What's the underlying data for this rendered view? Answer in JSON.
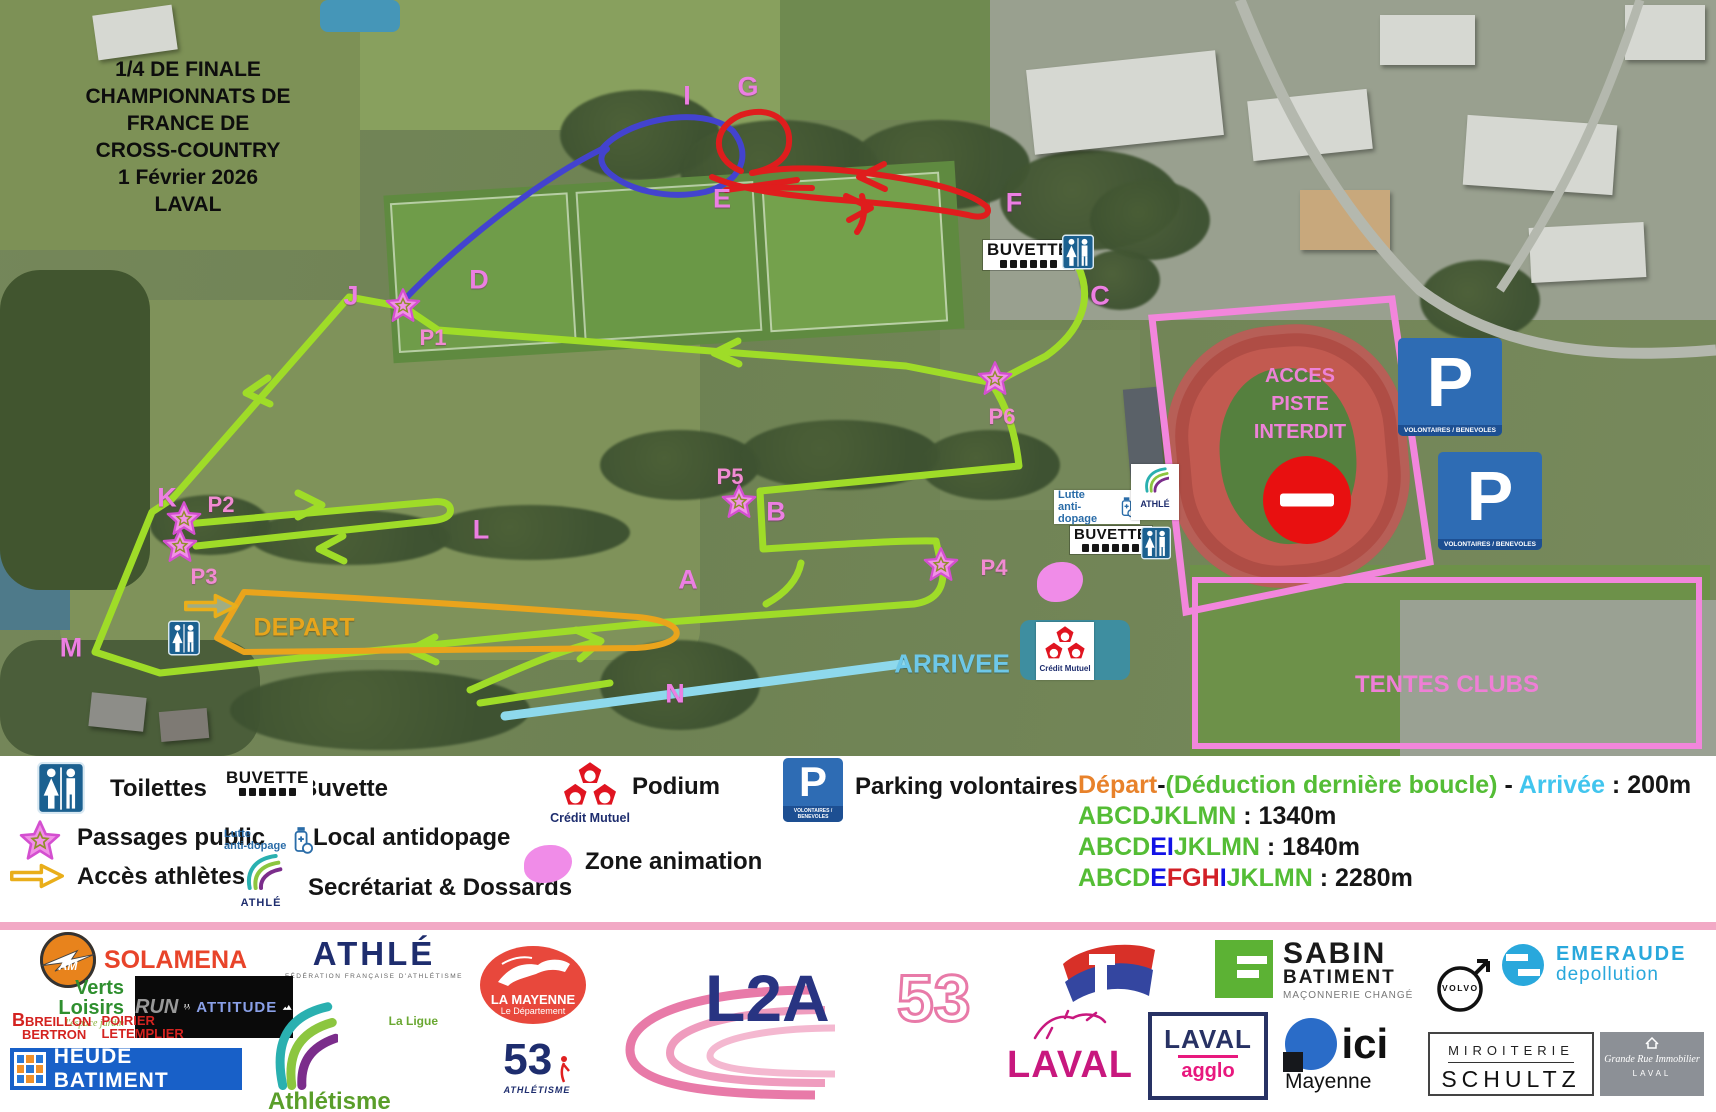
{
  "event": {
    "title_lines": [
      "1/4 DE FINALE",
      "CHAMPIONNATS DE FRANCE DE",
      "CROSS-COUNTRY",
      "1 Février 2026",
      "LAVAL"
    ]
  },
  "map": {
    "letters": [
      {
        "t": "I",
        "x": 687,
        "y": 96
      },
      {
        "t": "G",
        "x": 748,
        "y": 87
      },
      {
        "t": "E",
        "x": 722,
        "y": 199
      },
      {
        "t": "F",
        "x": 1014,
        "y": 203
      },
      {
        "t": "D",
        "x": 479,
        "y": 280
      },
      {
        "t": "J",
        "x": 351,
        "y": 296
      },
      {
        "t": "C",
        "x": 1100,
        "y": 296
      },
      {
        "t": "B",
        "x": 776,
        "y": 512
      },
      {
        "t": "A",
        "x": 688,
        "y": 580
      },
      {
        "t": "K",
        "x": 167,
        "y": 498
      },
      {
        "t": "L",
        "x": 481,
        "y": 530
      },
      {
        "t": "M",
        "x": 71,
        "y": 648
      },
      {
        "t": "N",
        "x": 675,
        "y": 694
      }
    ],
    "passages": [
      {
        "t": "P1",
        "lx": 433,
        "ly": 338,
        "sx": 403,
        "sy": 308
      },
      {
        "t": "P2",
        "lx": 221,
        "ly": 505,
        "sx": 184,
        "sy": 521
      },
      {
        "t": "P3",
        "lx": 204,
        "ly": 577,
        "sx": 180,
        "sy": 548
      },
      {
        "t": "P4",
        "lx": 994,
        "ly": 568,
        "sx": 941,
        "sy": 567
      },
      {
        "t": "P5",
        "lx": 730,
        "ly": 477,
        "sx": 739,
        "sy": 504
      },
      {
        "t": "P6",
        "lx": 1002,
        "ly": 417,
        "sx": 995,
        "sy": 381
      }
    ],
    "depart": "DEPART",
    "arrivee": "ARRIVEE",
    "acces_lines": [
      "ACCES",
      "PISTE",
      "INTERDIT"
    ],
    "tentes": "TENTES CLUBS"
  },
  "signs": {
    "buvette": "BUVETTE",
    "parking_letter": "P",
    "parking_sub": "VOLONTAIRES / BENEVOLES",
    "lutte_1": "Lutte",
    "lutte_2": "anti-dopage",
    "athle": "ATHLÉ",
    "ligue_mini": "Athlétisme"
  },
  "legend": {
    "toilettes": "Toilettes",
    "buvette": "Buvette",
    "passages": "Passages public",
    "local_antidopage": "Local antidopage",
    "acces_athletes": "Accès athlètes",
    "secretariat": "Secrétariat & Dossards",
    "podium": "Podium",
    "zone_animation": "Zone animation",
    "parking": "Parking volontaires",
    "credit_mutuel": "Crédit Mutuel"
  },
  "distances": {
    "lines": [
      [
        {
          "t": "Départ",
          "c": "orange"
        },
        {
          "t": "-",
          "c": "black"
        },
        {
          "t": "(Déduction dernière boucle)",
          "c": "green"
        },
        {
          "t": " - ",
          "c": "black"
        },
        {
          "t": "Arrivée",
          "c": "cyan"
        },
        {
          "t": " : ",
          "c": "black"
        },
        {
          "t": "200m",
          "c": "black"
        }
      ],
      [
        {
          "t": "ABCDJKLMN",
          "c": "green"
        },
        {
          "t": " : ",
          "c": "black"
        },
        {
          "t": "1340m",
          "c": "black"
        }
      ],
      [
        {
          "t": "ABCD",
          "c": "green"
        },
        {
          "t": "EI",
          "c": "blue"
        },
        {
          "t": "JKLMN",
          "c": "green"
        },
        {
          "t": " : ",
          "c": "black"
        },
        {
          "t": "1840m",
          "c": "black"
        }
      ],
      [
        {
          "t": "ABCD",
          "c": "green"
        },
        {
          "t": "E",
          "c": "blue"
        },
        {
          "t": "FGH",
          "c": "red"
        },
        {
          "t": "I",
          "c": "blue"
        },
        {
          "t": "JKLMN",
          "c": "green"
        },
        {
          "t": " : ",
          "c": "black"
        },
        {
          "t": "2280m",
          "c": "black"
        }
      ]
    ]
  },
  "colors": {
    "green": "#54bd35",
    "blue": "#1212e6",
    "red": "#d22027",
    "orange": "#e8822b",
    "cyan": "#41c5ee",
    "black": "#161616",
    "course_green": "#9fdc28",
    "course_blue": "#4343cf",
    "course_red": "#df1d1d",
    "course_orange": "#eaa41c",
    "course_cyan": "#8ed9ec",
    "pink_outline": "#f286dc"
  },
  "sponsors": {
    "solamena": {
      "name": "SOLAMENA",
      "mono": "AM"
    },
    "verts_loisirs": {
      "name": "Verts Loisirs",
      "sub": "l'espace jardin"
    },
    "breillon": {
      "l1": "BREILLON",
      "l2": "BERTRON",
      "r1": "POIRIER",
      "r2": "LETEMPLIER"
    },
    "run_attitude": {
      "a": "RUN",
      "b": "ATTITUDE"
    },
    "heude": "HEUDE BATIMENT",
    "athle_ffa": {
      "name": "ATHLÉ",
      "sub": "FÉDÉRATION FRANÇAISE D'ATHLÉTISME"
    },
    "ligue": {
      "a": "La Ligue",
      "b": "Athlétisme",
      "c": "en Pays de la Loire"
    },
    "mayenne": {
      "a": "LA MAYENNE",
      "b": "Le Département"
    },
    "athle53": {
      "a": "53",
      "b": "ATHLÉTISME"
    },
    "l2a53": {
      "a": "L2A",
      "b": "53"
    },
    "laval": "LAVAL",
    "sabin": {
      "a": "SABIN",
      "b": "BATIMENT",
      "c": "MAÇONNERIE CHANGÉ"
    },
    "laval_agglo": {
      "a": "LAVAL",
      "b": "agglo"
    },
    "volvo": "VOLVO",
    "emeraude": {
      "a": "EMERAUDE",
      "b": "depollution"
    },
    "ici": {
      "a": "ici",
      "b": "Mayenne"
    },
    "schultz": {
      "a": "MIROITERIE",
      "b": "SCHULTZ"
    },
    "grande_rue": {
      "a": "Grande Rue Immobilier",
      "b": "LAVAL"
    }
  }
}
